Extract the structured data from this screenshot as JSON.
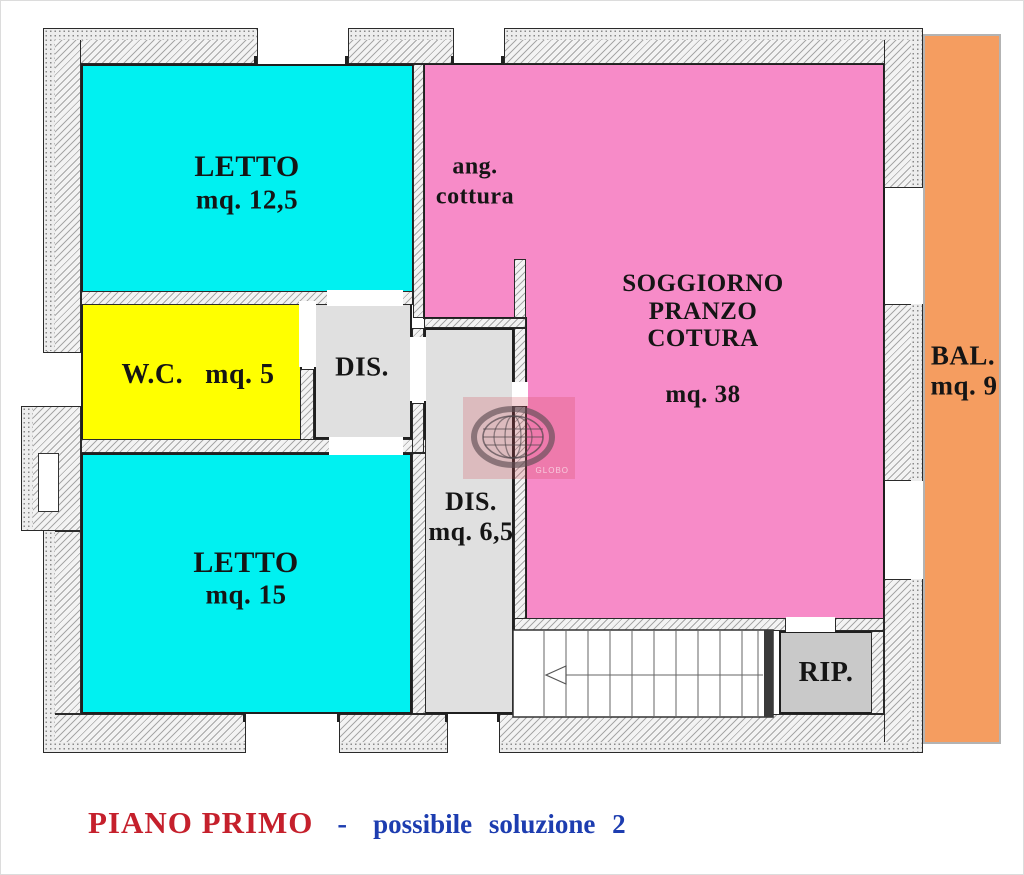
{
  "document_type": "floor-plan-drawing",
  "plan": {
    "rooms": [
      {
        "id": "letto-1",
        "name": "LETTO",
        "area": "mq. 12,5"
      },
      {
        "id": "wc",
        "name": "W.C.",
        "area": "mq. 5"
      },
      {
        "id": "disimpegno-1",
        "name": "DIS.",
        "area": ""
      },
      {
        "id": "letto-2",
        "name": "LETTO",
        "area": "mq. 15"
      },
      {
        "id": "disimpegno-2",
        "name": "DIS.",
        "area": "mq. 6,5"
      },
      {
        "id": "soggiorno",
        "lines": [
          "SOGGIORNO",
          "PRANZO",
          "COTURA"
        ],
        "area": "mq. 38"
      },
      {
        "id": "angolo-cottura",
        "lines": [
          "ang.",
          "cottura"
        ]
      },
      {
        "id": "ripostiglio",
        "name": "RIP."
      },
      {
        "id": "balcone",
        "name": "BAL.",
        "area": "mq. 9"
      }
    ],
    "colors": {
      "bedroom": "#00f1f1",
      "bathroom": "#ffff00",
      "hallway": "#e0e0e0",
      "living": "#f78bc8",
      "storage": "#c9c9c9",
      "balcony": "#f59d60"
    }
  },
  "caption": {
    "title": "PIANO PRIMO",
    "separator": "-",
    "subtitle": "possibile soluzione 2",
    "title_color": "#c5202c",
    "subtitle_color": "#1d3db0"
  },
  "watermark": {
    "text": "GLOBO"
  }
}
